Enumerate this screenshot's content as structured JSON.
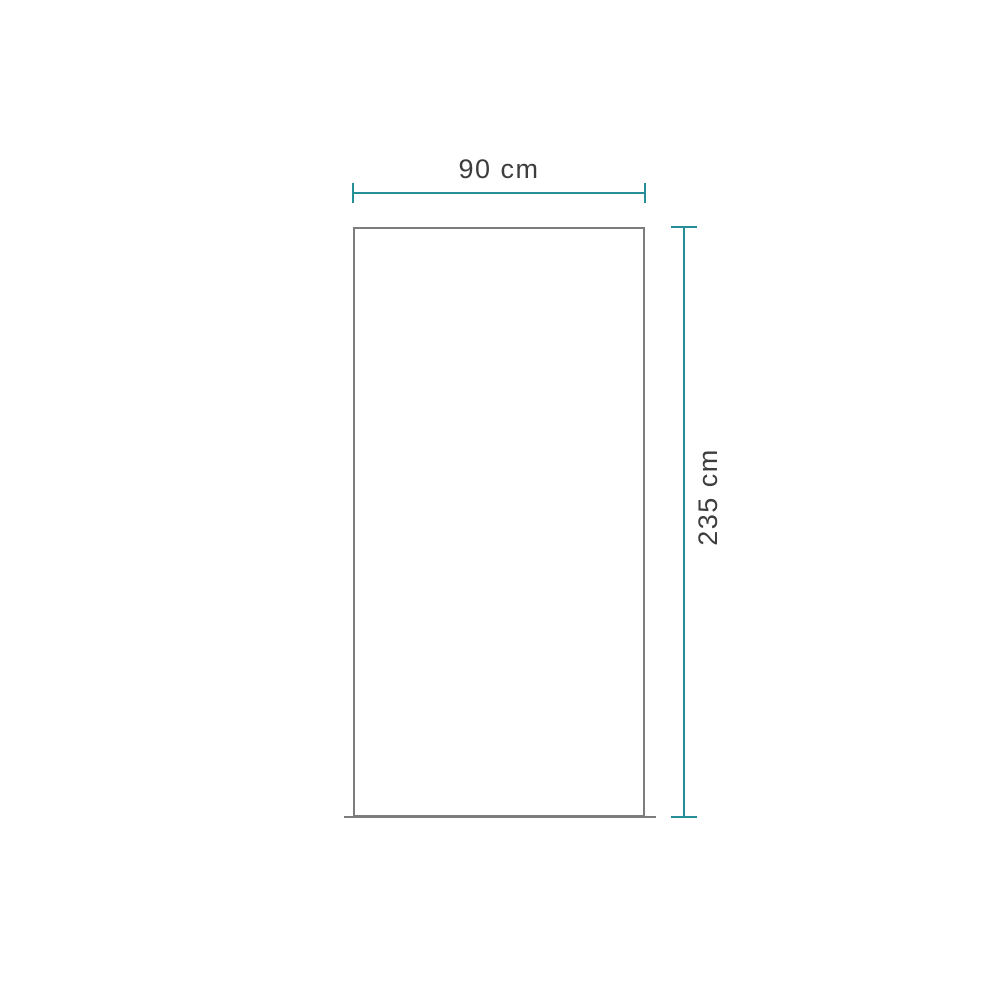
{
  "diagram": {
    "kind": "product-dimension-drawing",
    "dimensions": {
      "width": {
        "value": 90,
        "unit": "cm",
        "label": "90 cm"
      },
      "height": {
        "value": 235,
        "unit": "cm",
        "label": "235 cm"
      }
    },
    "colors": {
      "dimension_line": "#258e96",
      "panel_outline": "#7d7d7d",
      "label_text": "#3d3d3d",
      "background": "#ffffff"
    }
  }
}
